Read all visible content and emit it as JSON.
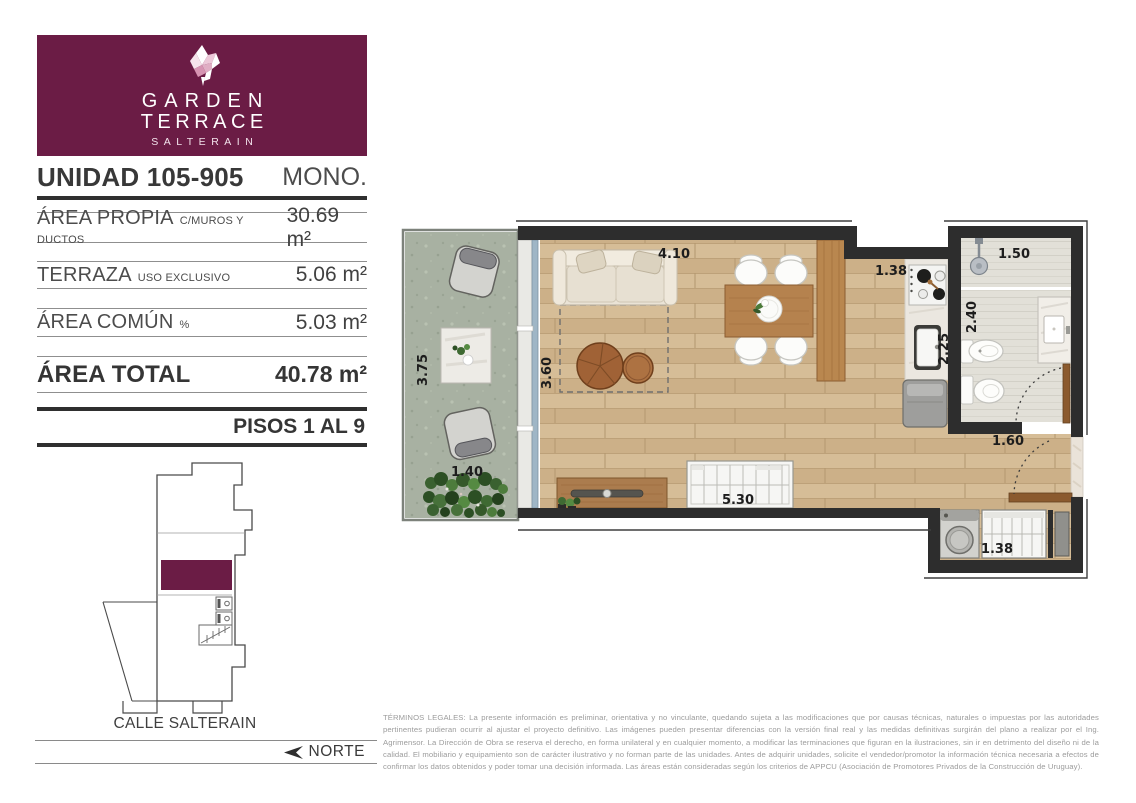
{
  "brand": {
    "name_line1": "GARDEN",
    "name_line2": "TERRACE",
    "name_line3": "SALTERAIN",
    "bg_color": "#6B1C45"
  },
  "unit": {
    "number": "UNIDAD 105-905",
    "type": "MONO."
  },
  "areas": {
    "rows": [
      {
        "label": "ÁREA PROPIA",
        "sublabel": "C/MUROS Y DUCTOS",
        "value": "30.69 m²"
      },
      {
        "label": "TERRAZA",
        "sublabel": "USO EXCLUSIVO",
        "value": "5.06 m²"
      },
      {
        "label": "ÁREA COMÚN",
        "sublabel": "%",
        "value": "5.03 m²"
      }
    ],
    "total": {
      "label": "ÁREA TOTAL",
      "value": "40.78 m²"
    },
    "floors_label": "PISOS 1 AL 9"
  },
  "keyplan": {
    "street_label": "CALLE SALTERAIN",
    "north_label": "NORTE",
    "highlight_color": "#6B1C45"
  },
  "plan": {
    "dims": {
      "living_width": "4.10",
      "living_depth": "3.60",
      "terrace_depth": "3.75",
      "terrace_width": "1.40",
      "kitchen_width": "1.38",
      "counter_depth": "2.25",
      "bath_width": "1.50",
      "bath_depth": "2.40",
      "hall_width": "1.60",
      "closet_width": "5.30",
      "laundry_width": "1.38"
    }
  },
  "legal_text": "TÉRMINOS LEGALES: La presente información es preliminar, orientativa y no vinculante, quedando sujeta a las modificaciones que por causas técnicas, naturales o impuestas por las autoridades pertinentes pudieran ocurrir al ajustar el proyecto definitivo. Las imágenes pueden presentar diferencias con la versión final real y las medidas definitivas surgirán del plano a realizar por el Ing. Agrimensor. La Dirección de Obra se reserva el derecho, en forma unilateral y en cualquier momento, a modificar las terminaciones que figuran en la ilustraciones, sin ir en detrimento del diseño ni de la calidad. El mobiliario y equipamiento son de carácter ilustrativo y no forman parte de las unidades. Antes de adquirir unidades, solicite el vendedor/promotor la información técnica necesaria a efectos de confirmar los datos obtenidos y poder tomar una decisión informada. Las áreas están consideradas según los criterios de APPCU (Asociación de Promotores Privados de la Construcción de Uruguay)."
}
